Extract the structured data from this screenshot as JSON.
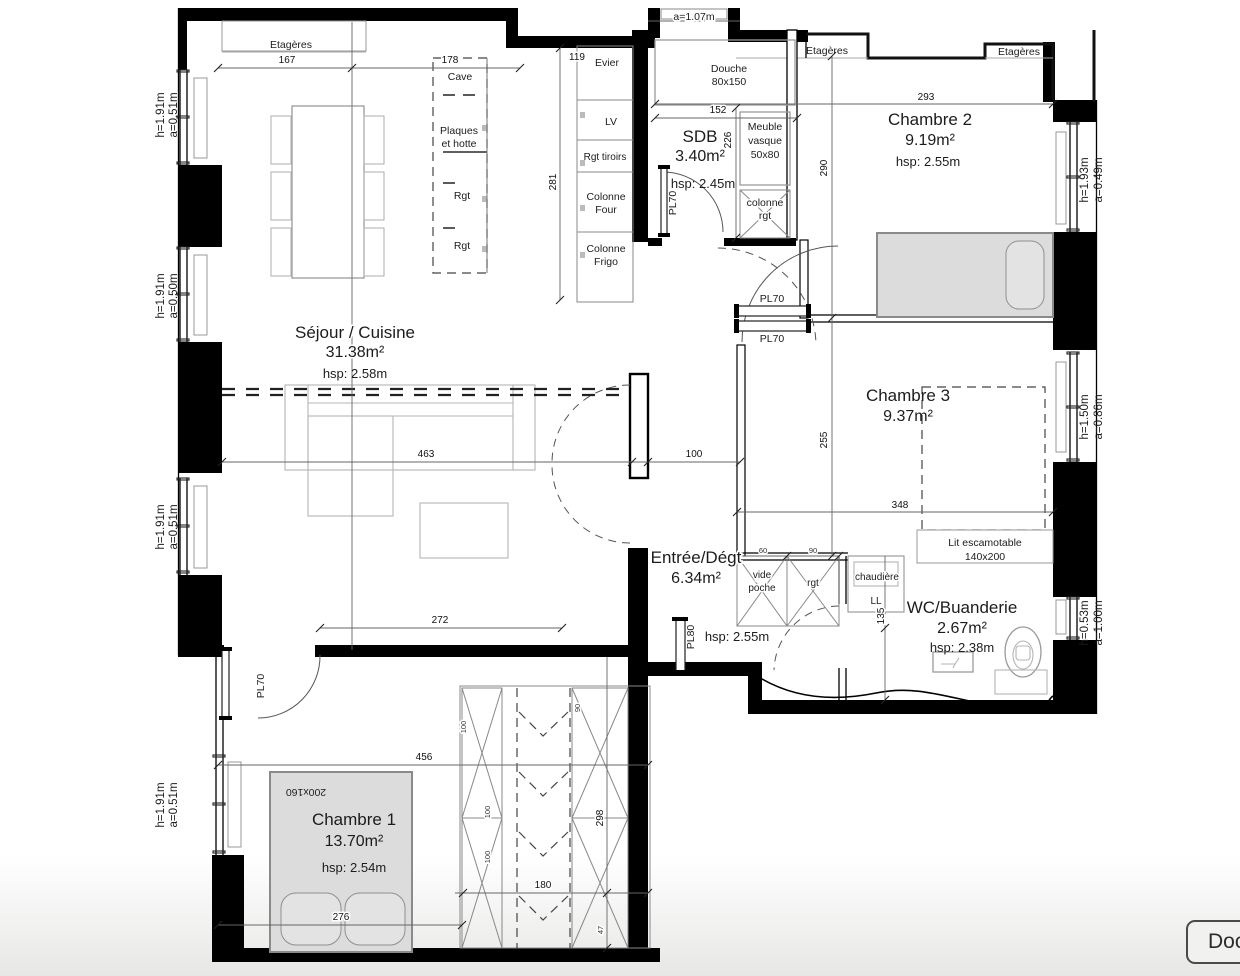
{
  "plan": {
    "rooms": {
      "sejour": {
        "name": "Séjour / Cuisine",
        "area": "31.38m²",
        "hsp": "hsp: 2.58m"
      },
      "sdb": {
        "name": "SDB",
        "area": "3.40m²",
        "hsp": "hsp: 2.45m"
      },
      "chambre2": {
        "name": "Chambre 2",
        "area": "9.19m²",
        "hsp": "hsp: 2.55m"
      },
      "chambre3": {
        "name": "Chambre 3",
        "area": "9.37m²"
      },
      "entree": {
        "name": "Entrée/Dégt",
        "area": "6.34m²",
        "hsp": "hsp: 2.55m"
      },
      "wc": {
        "name": "WC/Buanderie",
        "area": "2.67m²",
        "hsp": "hsp: 2.38m"
      },
      "chambre1": {
        "name": "Chambre 1",
        "area": "13.70m²",
        "hsp": "hsp: 2.54m"
      }
    },
    "kitchen": {
      "evier": "Evier",
      "lv": "LV",
      "rgt_tiroirs": "Rgt tiroirs",
      "colonne_a1": "Colonne",
      "colonne_a2": "Four",
      "colonne_b1": "Colonne",
      "colonne_b2": "Frigo",
      "cave": "Cave",
      "plaques": "Plaques",
      "et_hotte": "et hotte",
      "rgt_a": "Rgt",
      "rgt_b": "Rgt"
    },
    "sdb_items": {
      "douche": "Douche",
      "douche_size": "80x150",
      "meuble": "Meuble",
      "vasque": "vasque",
      "vasque_size": "50x80",
      "colonne": "colonne",
      "rgt": "rgt",
      "pl70": "PL70"
    },
    "storage": {
      "etageres_left": "Etagères",
      "etageres_mid": "Etagères",
      "etageres_right": "Etagères",
      "pl70_top": "PL70",
      "pl70_bottom": "PL70",
      "pl70_ch1": "PL70",
      "pl80": "PL80",
      "vide": "vide",
      "poche": "poche",
      "rgt": "rgt",
      "chaudiere": "chaudière",
      "ll": "LL",
      "lit": "Lit escamotable",
      "lit_size": "140x200",
      "bed_size": "200x160"
    },
    "entrance": {
      "label": "a=1.07m"
    },
    "windows": {
      "l1_h": "h=1.91m",
      "l1_a": "a=0.51m",
      "l2_h": "h=1.91m",
      "l2_a": "a=0.50m",
      "l3_h": "h=1.91m",
      "l3_a": "a=0.51m",
      "l4_h": "h=1.91m",
      "l4_a": "a=0.51m",
      "r1_h": "h=1.93m",
      "r1_a": "a=0.49m",
      "r2_h": "h=1.50m",
      "r2_a": "a=0.86m",
      "r3_h": "h=0.53m",
      "r3_a": "a=1.00m"
    },
    "dims": {
      "d167": "167",
      "d178": "178",
      "d119": "119",
      "d281": "281",
      "d152": "152",
      "d293": "293",
      "d226": "226",
      "d290": "290",
      "d255": "255",
      "d348": "348",
      "d463": "463",
      "d100": "100",
      "d272": "272",
      "d135": "135",
      "d456": "456",
      "d276": "276",
      "d298": "298",
      "d180": "180",
      "d60": "60",
      "d90": "90",
      "d90b": "90",
      "d100a": "100",
      "d100b": "100",
      "d100c": "100",
      "d47": "47"
    }
  },
  "ui": {
    "doc_button": "Docu"
  }
}
